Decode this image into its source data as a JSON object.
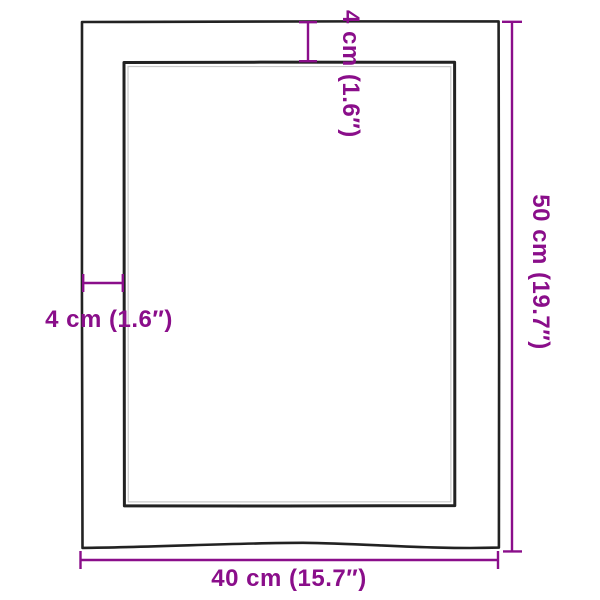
{
  "diagram": {
    "title": "product-dimension-diagram",
    "labels": {
      "top_thickness": "4 cm (1.6″)",
      "left_thickness": "4 cm (1.6″)",
      "height": "50 cm (19.7″)",
      "width": "40 cm (15.7″)"
    },
    "colors": {
      "dimension": "#8A0E8A",
      "outline": "#222222",
      "soft_outline": "#9E9E9E",
      "background": "#FFFFFF"
    }
  }
}
